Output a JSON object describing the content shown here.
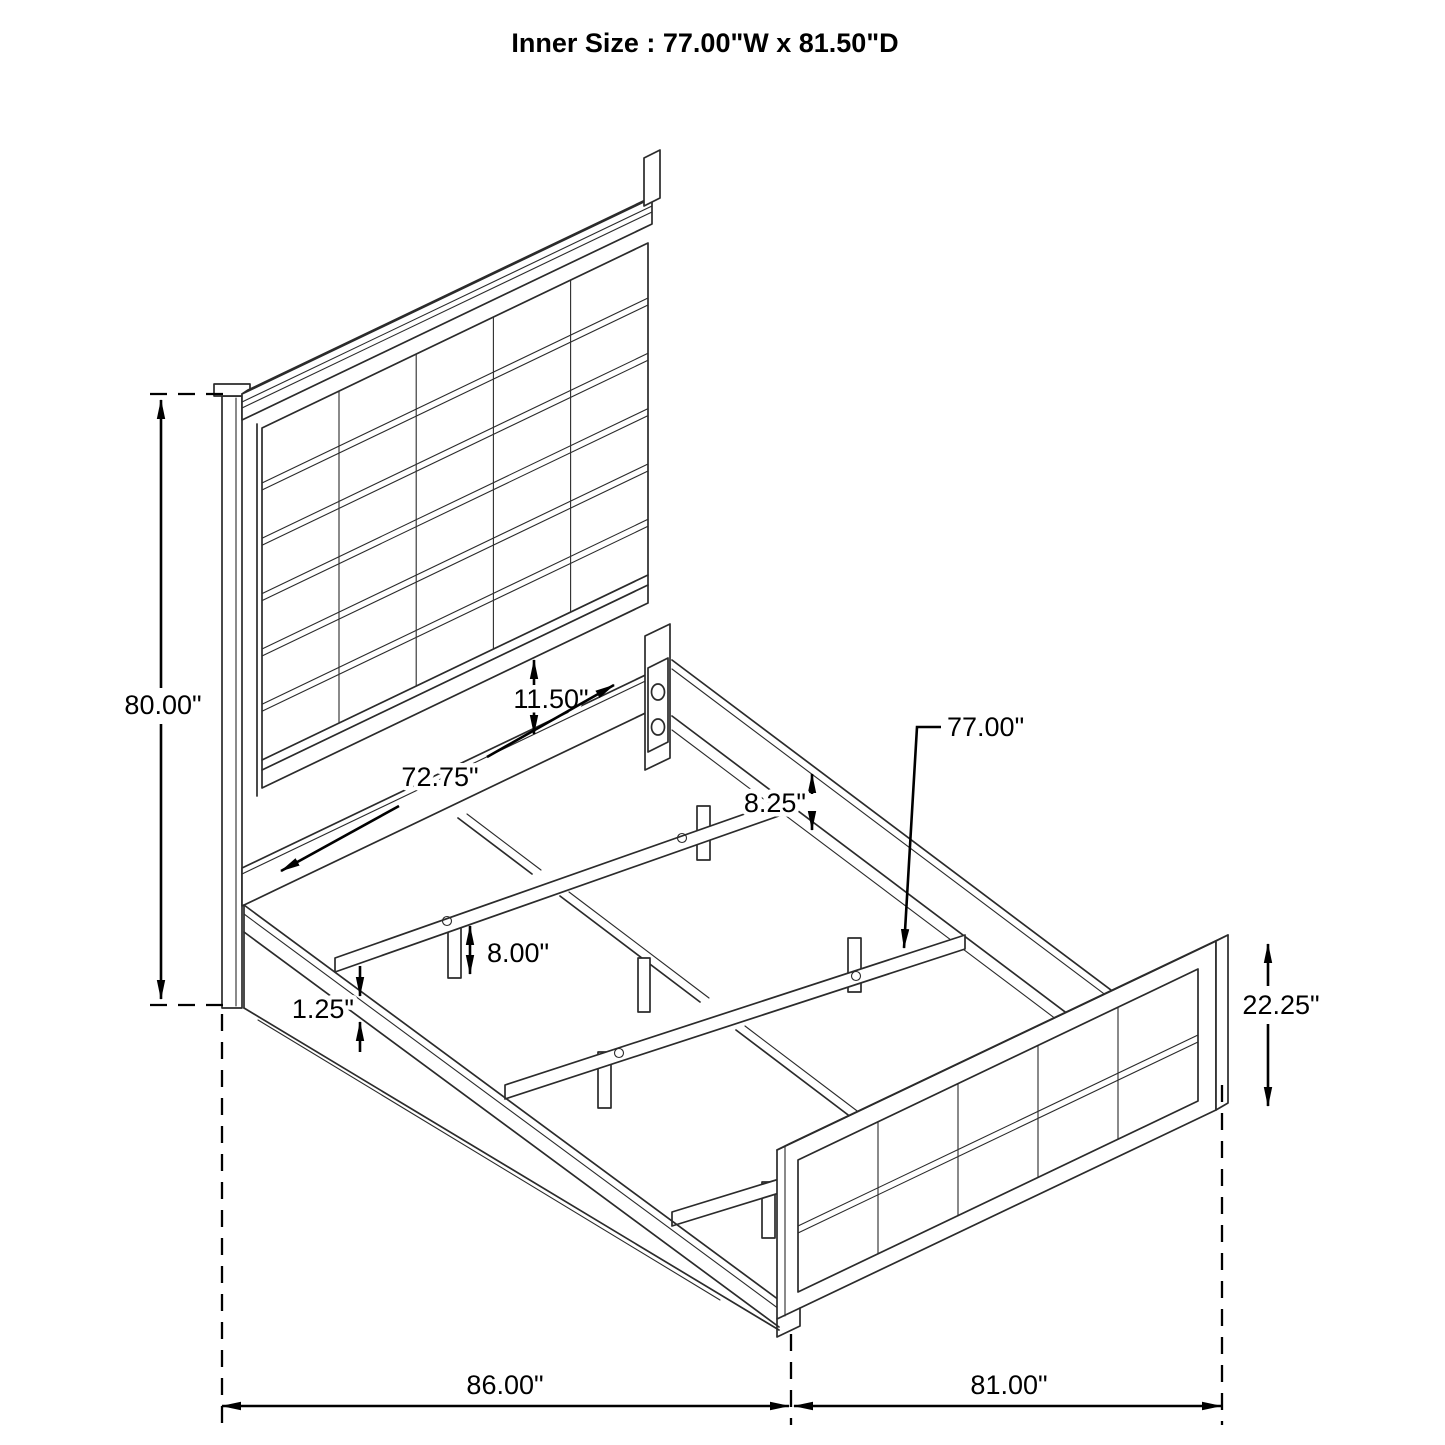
{
  "title": "Inner Size : 77.00\"W x 81.50\"D",
  "diagram": {
    "type": "isometric-bed-frame-dimension-drawing",
    "dimensions": {
      "headboard_height": "80.00\"",
      "panel_gap": "11.50\"",
      "inner_width": "72.75\"",
      "rail_height": "8.25\"",
      "slat_length": "77.00\"",
      "leg_height": "8.00\"",
      "rail_lip": "1.25\"",
      "footboard_height": "22.25\"",
      "overall_length": "86.00\"",
      "overall_width": "81.00\""
    }
  }
}
